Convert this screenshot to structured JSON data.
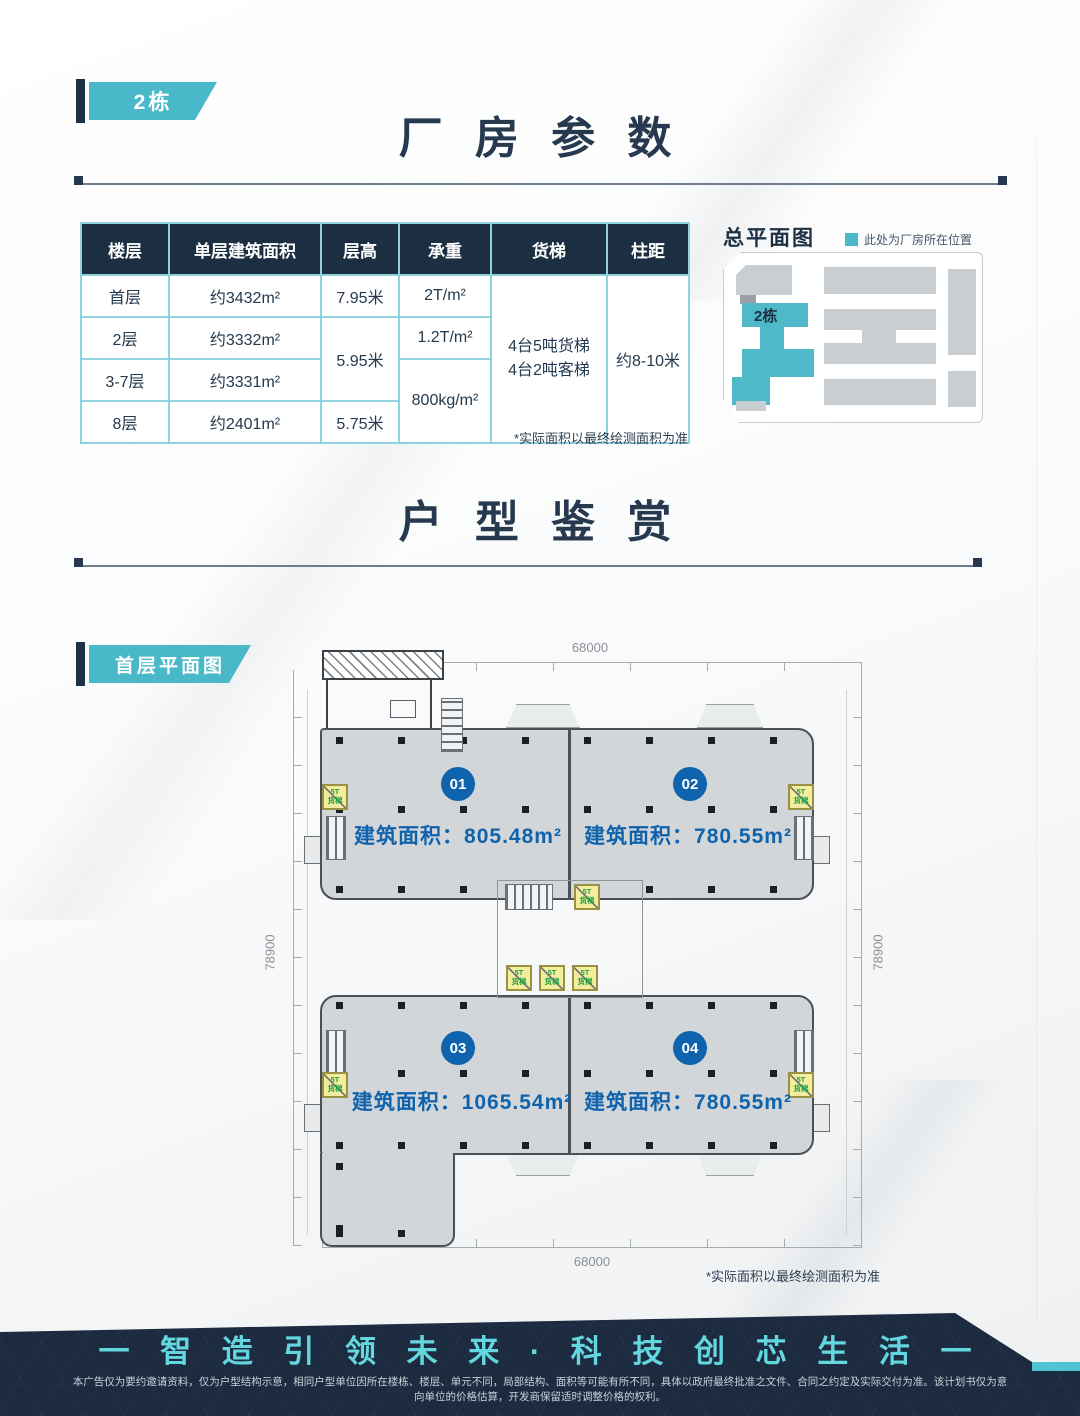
{
  "page": {
    "building_badge": "2栋",
    "plan_badge": "首层平面图"
  },
  "sections": {
    "params_title": "厂 房 参 数",
    "units_title": "户 型 鉴 赏"
  },
  "params_table": {
    "headers": [
      "楼层",
      "单层建筑面积",
      "层高",
      "承重",
      "货梯",
      "柱距"
    ],
    "floors": [
      "首层",
      "2层",
      "3-7层",
      "8层"
    ],
    "areas": [
      "约3432m²",
      "约3332m²",
      "约3331m²",
      "约2401m²"
    ],
    "heights": {
      "r1": "7.95米",
      "r2_3": "5.95米",
      "r4": "5.75米"
    },
    "loads": {
      "r1": "2T/m²",
      "r2": "1.2T/m²",
      "r3_4": "800kg/m²"
    },
    "freight_elevator": [
      "4台5吨货梯",
      "4台2吨客梯"
    ],
    "column_spacing": "约8-10米",
    "footnote": "*实际面积以最终绘测面积为准"
  },
  "site_plan": {
    "title": "总平面图",
    "legend": "此处为厂房所在位置",
    "highlight_label": "2栋",
    "highlight_color": "#4fb9c9"
  },
  "floor_plan": {
    "dim_top": "68000",
    "dim_bottom": "68000",
    "dim_left": "78900",
    "dim_right": "78900",
    "area_prefix": "建筑面积：",
    "units": [
      {
        "no": "01",
        "area": "805.48m²"
      },
      {
        "no": "02",
        "area": "780.55m²"
      },
      {
        "no": "03",
        "area": "1065.54m²"
      },
      {
        "no": "04",
        "area": "780.55m²"
      }
    ],
    "lift_line1": "5T",
    "lift_line2": "货梯",
    "footnote": "*实际面积以最终绘测面积为准"
  },
  "footer": {
    "slogan": "一 智 造 引 领 未 来 · 科 技 创 芯 生 活 一",
    "disclaimer": "本广告仅为要约邀请资料，仅为户型结构示意，相同户型单位因所在楼栋、楼层、单元不同，局部结构、面积等可能有所不同，具体以政府最终批准之文件、合同之约定及实际交付为准。该计划书仅为意向单位的价格估算，开发商保留适时调整价格的权利。",
    "accent_color": "#4fc3cf"
  },
  "colors": {
    "navy": "#1c2f42",
    "teal": "#49b8c8",
    "blue": "#0f63ac",
    "table_border": "#8ed3dd"
  }
}
